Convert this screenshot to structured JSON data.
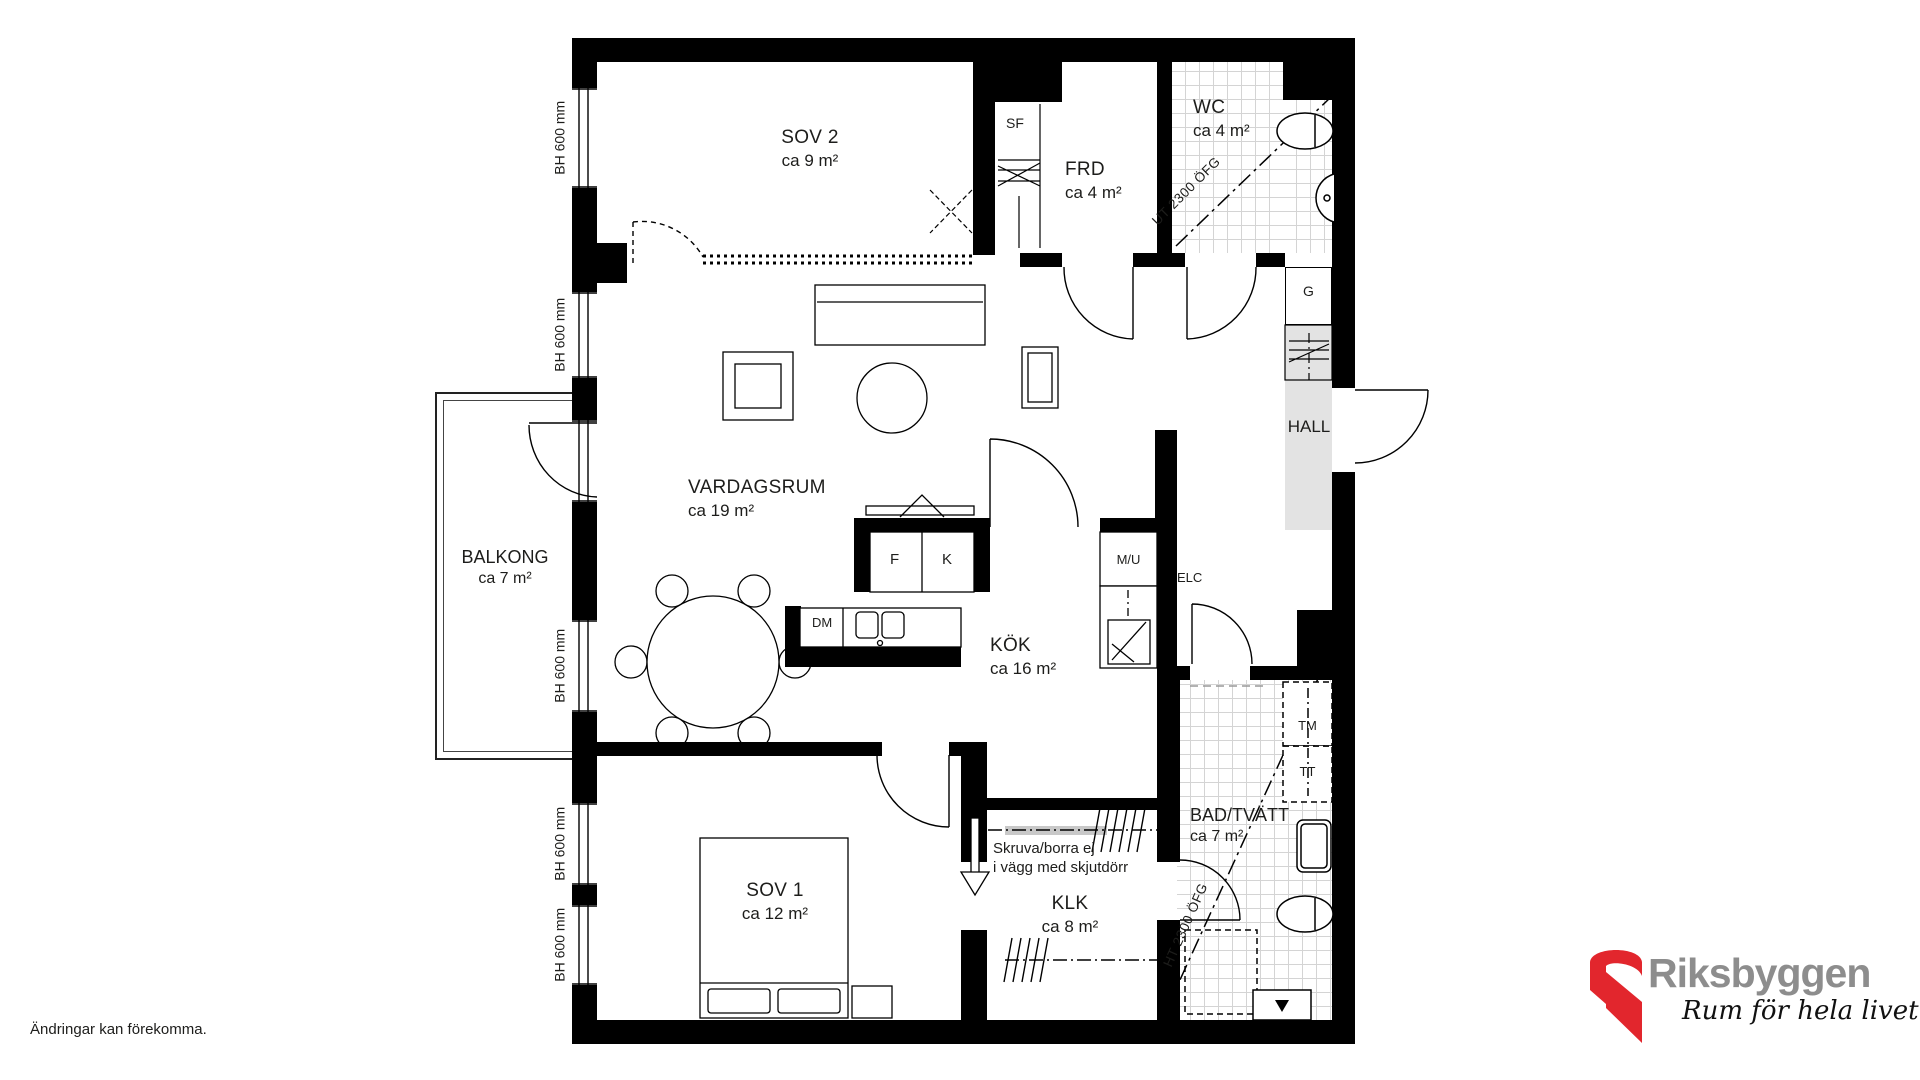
{
  "plan": {
    "rooms": {
      "sov2": {
        "name": "SOV 2",
        "area": "ca 9 m²"
      },
      "frd": {
        "name": "FRD",
        "area": "ca 4 m²"
      },
      "wc": {
        "name": "WC",
        "area": "ca 4 m²"
      },
      "hall": {
        "name": "HALL"
      },
      "vardagsrum": {
        "name": "VARDAGSRUM",
        "area": "ca 19 m²"
      },
      "balkong": {
        "name": "BALKONG",
        "area": "ca 7 m²"
      },
      "kok": {
        "name": "KÖK",
        "area": "ca 16 m²"
      },
      "sov1": {
        "name": "SOV 1",
        "area": "ca 12 m²"
      },
      "klk": {
        "name": "KLK",
        "area": "ca 8 m²"
      },
      "bad": {
        "name": "BAD/TVÄTT",
        "area": "ca 7 m²"
      }
    },
    "fixtures": {
      "sf": "SF",
      "garderob": "G",
      "fridge": "F",
      "freezer": "K",
      "micro_oven": "M/U",
      "elc": "ELC",
      "dishwasher": "DM",
      "washer": "TM",
      "dryer": "TT"
    },
    "annotations": {
      "window_height": "BH 600 mm",
      "wc_ceiling": "UT 2300 ÖFG",
      "bad_ceiling": "HT 2300 ÖFG",
      "sliding_wall_warning_line1": "Skruva/borra ej",
      "sliding_wall_warning_line2": "i vägg med skjutdörr",
      "disclaimer": "Ändringar kan förekomma."
    },
    "logo": {
      "brand": "Riksbyggen",
      "tagline": "Rum för hela livet"
    },
    "colors": {
      "wall": "#000000",
      "hall_floor": "#e3e3e3",
      "tile_line": "#d4d4d4",
      "logo_red": "#e2262d",
      "logo_gray": "#8d8d8d"
    }
  }
}
